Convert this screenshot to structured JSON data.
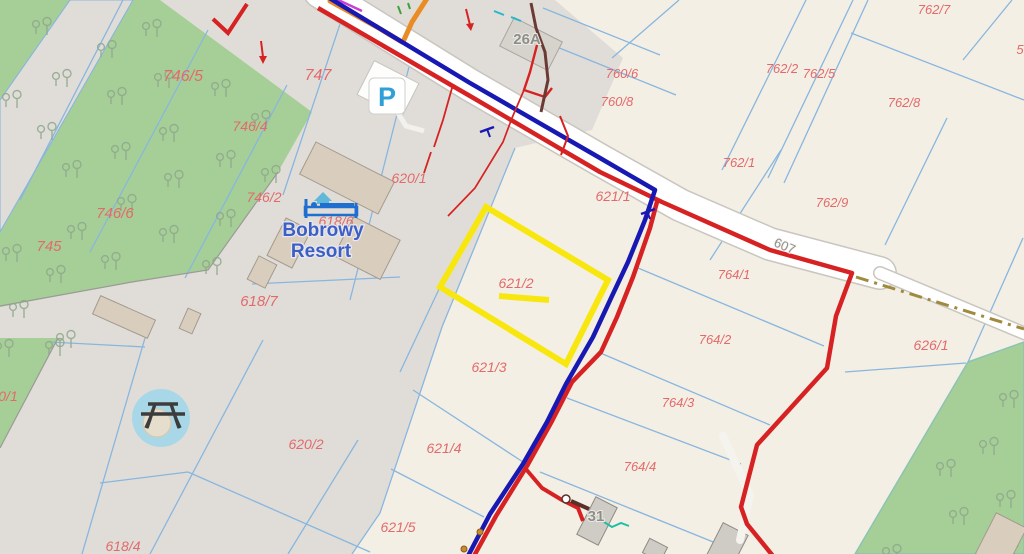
{
  "map": {
    "selected_parcel": "621/2",
    "poi": {
      "resort_name_line1": "Bobrowy",
      "resort_name_line2": "Resort",
      "parking_symbol": "P",
      "icons": [
        "parking-icon",
        "lodging-icon",
        "picnic-table-icon",
        "tree-icon"
      ]
    },
    "parcel_labels": [
      {
        "text": "746/5",
        "x": 183,
        "y": 81,
        "s": 16
      },
      {
        "text": "747",
        "x": 318,
        "y": 80,
        "s": 16
      },
      {
        "text": "746/4",
        "x": 250,
        "y": 131,
        "s": 14
      },
      {
        "text": "746/2",
        "x": 264,
        "y": 202,
        "s": 14
      },
      {
        "text": "746/6",
        "x": 115,
        "y": 218,
        "s": 15
      },
      {
        "text": "745",
        "x": 49,
        "y": 251,
        "s": 15
      },
      {
        "text": "618/6",
        "x": 336,
        "y": 226,
        "s": 14
      },
      {
        "text": "618/7",
        "x": 259,
        "y": 306,
        "s": 15
      },
      {
        "text": "620/1",
        "x": 409,
        "y": 183,
        "s": 14
      },
      {
        "text": "621/1",
        "x": 613,
        "y": 201,
        "s": 14
      },
      {
        "text": "621/2",
        "x": 516,
        "y": 288,
        "s": 14
      },
      {
        "text": "621/3",
        "x": 489,
        "y": 372,
        "s": 14
      },
      {
        "text": "621/4",
        "x": 444,
        "y": 453,
        "s": 14
      },
      {
        "text": "621/5",
        "x": 398,
        "y": 532,
        "s": 14
      },
      {
        "text": "618/4",
        "x": 123,
        "y": 551,
        "s": 14
      },
      {
        "text": "620/2",
        "x": 306,
        "y": 449,
        "s": 14
      },
      {
        "text": "0/1",
        "x": 8,
        "y": 401,
        "s": 14
      },
      {
        "text": "760/6",
        "x": 622,
        "y": 78,
        "s": 13
      },
      {
        "text": "760/8",
        "x": 617,
        "y": 106,
        "s": 13
      },
      {
        "text": "762/1",
        "x": 739,
        "y": 167,
        "s": 13
      },
      {
        "text": "762/2",
        "x": 782,
        "y": 73,
        "s": 13
      },
      {
        "text": "762/5",
        "x": 819,
        "y": 78,
        "s": 13
      },
      {
        "text": "762/7",
        "x": 934,
        "y": 14,
        "s": 13
      },
      {
        "text": "762/8",
        "x": 904,
        "y": 107,
        "s": 13
      },
      {
        "text": "762/9",
        "x": 832,
        "y": 207,
        "s": 13
      },
      {
        "text": "764/1",
        "x": 734,
        "y": 279,
        "s": 13
      },
      {
        "text": "764/2",
        "x": 715,
        "y": 344,
        "s": 13
      },
      {
        "text": "764/3",
        "x": 678,
        "y": 407,
        "s": 13
      },
      {
        "text": "764/4",
        "x": 640,
        "y": 471,
        "s": 13
      },
      {
        "text": "626/1",
        "x": 931,
        "y": 350,
        "s": 14
      },
      {
        "text": "5",
        "x": 1020,
        "y": 54,
        "s": 13
      }
    ],
    "building_labels": [
      {
        "text": "26A",
        "x": 527,
        "y": 44
      },
      {
        "text": "31",
        "x": 596,
        "y": 521
      }
    ],
    "road_labels": [
      {
        "text": "607",
        "x": 783,
        "y": 250,
        "rotate": 23
      }
    ],
    "colors": {
      "land_cream": "#f4efe5",
      "land_gray": "#e0ddd8",
      "forest_green": "#a6cf97",
      "boundary_thin": "#88b6df",
      "line_navy": "#1818b2",
      "line_red": "#d62222",
      "line_orange": "#ea8c26",
      "line_magenta": "#cc3fd0",
      "selected_outline": "#f8e70e",
      "parcel_label": "#e26a6a",
      "building_label": "#8e8e88",
      "resort_text": "#3b5fc5",
      "track_dash": "#a08a3e",
      "building_fill": "#d9cdbe",
      "picnic_circle": "#a8d8e8"
    }
  }
}
